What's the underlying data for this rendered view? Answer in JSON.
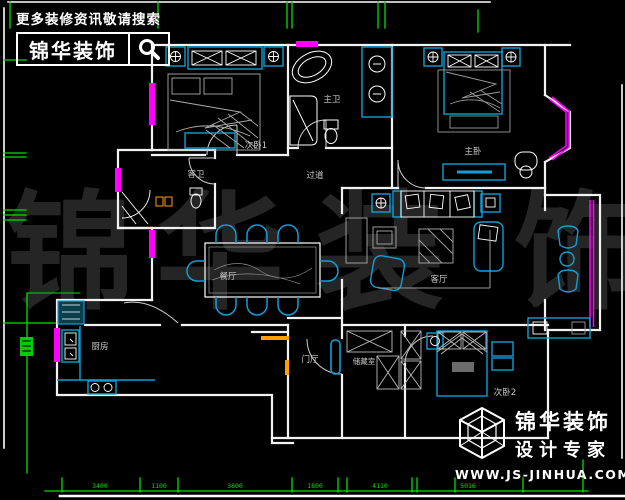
{
  "header_logo": {
    "tagline": "更多装修资讯敬请搜索",
    "brand": "锦华装饰",
    "icon": "search-icon"
  },
  "footer_logo": {
    "brand": "锦华装饰",
    "subtitle": "设计专家",
    "url": "WWW.JS-JINHUA.COM",
    "icon": "cube-logo-icon"
  },
  "watermark": {
    "chars": [
      "锦",
      "华",
      "装",
      "饰"
    ]
  },
  "rooms": {
    "bedroom1": "次卧1",
    "master_bath": "主卫",
    "master_bedroom": "主卧",
    "guest_bath": "客卫",
    "hallway": "过道",
    "dining": "餐厅",
    "living": "客厅",
    "kitchen": "厨房",
    "entry": "门厅",
    "storage": "储藏室",
    "bedroom2": "次卧2"
  },
  "dimensions": {
    "bottom": [
      "3400",
      "1100",
      "3600",
      "1800",
      "4110",
      "5016"
    ]
  },
  "colors": {
    "background": "#000000",
    "wall": "#f2f2f2",
    "furniture_cyan": "#0f9fd8",
    "window_magenta": "#ff00ff",
    "dimension_green": "#00e000",
    "door_orange": "#ffa000",
    "watermark_gray": "#252525",
    "label_gray": "#c9c9c9"
  }
}
